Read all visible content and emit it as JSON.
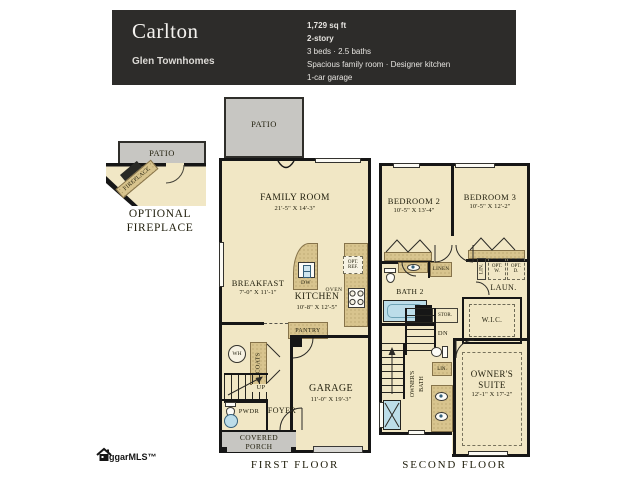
{
  "header": {
    "title": "Carlton",
    "community": "Glen Townhomes",
    "specs": {
      "sqft": "1,729 sq ft",
      "story": "2-story",
      "beds": "3 beds · 2.5 baths",
      "features": "Spacious family room · Designer kitchen",
      "garage": "1-car garage"
    }
  },
  "inset": {
    "patio": "PATIO",
    "fireplace": "FIREPLACE",
    "caption": "OPTIONAL FIREPLACE"
  },
  "first": {
    "caption": "FIRST FLOOR",
    "patio": "PATIO",
    "family": "FAMILY ROOM",
    "family_dims": "21'-5\" X 14'-3\"",
    "breakfast": "BREAKFAST",
    "breakfast_dims": "7'-0\" X 11'-1\"",
    "kitchen": "KITCHEN",
    "kitchen_dims": "10'-8\" X 12'-5\"",
    "garage": "GARAGE",
    "garage_dims": "11'-0\" X 19'-3\"",
    "pantry": "PANTRY",
    "coats": "COATS",
    "up": "UP",
    "wh": "WH",
    "pwdr": "PWDR",
    "foyer": "FOYER",
    "porch": "COVERED PORCH",
    "opt_ref": "OPT. REF.",
    "oven": "OVEN",
    "dw": "DW"
  },
  "second": {
    "caption": "SECOND FLOOR",
    "bed2": "BEDROOM 2",
    "bed2_dims": "10'-5\" X 13'-4\"",
    "bed3": "BEDROOM 3",
    "bed3_dims": "10'-5\" X 12'-2\"",
    "bath2": "BATH 2",
    "linen": "LINEN",
    "lin_hall": "LIN.",
    "laun": "LAUN.",
    "opt_w": "OPT. W.",
    "opt_d": "OPT. D.",
    "stor": "STOR.",
    "dn": "DN",
    "wic": "W.I.C.",
    "owners_bath": "OWNER'S BATH",
    "lin_bath": "LIN.",
    "suite": "OWNER'S SUITE",
    "suite_dims": "12'-1\" X 17'-2\""
  },
  "footer": {
    "logo": "ggarMLS™"
  },
  "colors": {
    "header_bg": "#2d2c2a",
    "floor": "#f1e7c5",
    "cabinet": "#d8c48e",
    "patio": "#c7c6c2",
    "wall": "#161616",
    "water_fixture": "#bcdde9"
  }
}
